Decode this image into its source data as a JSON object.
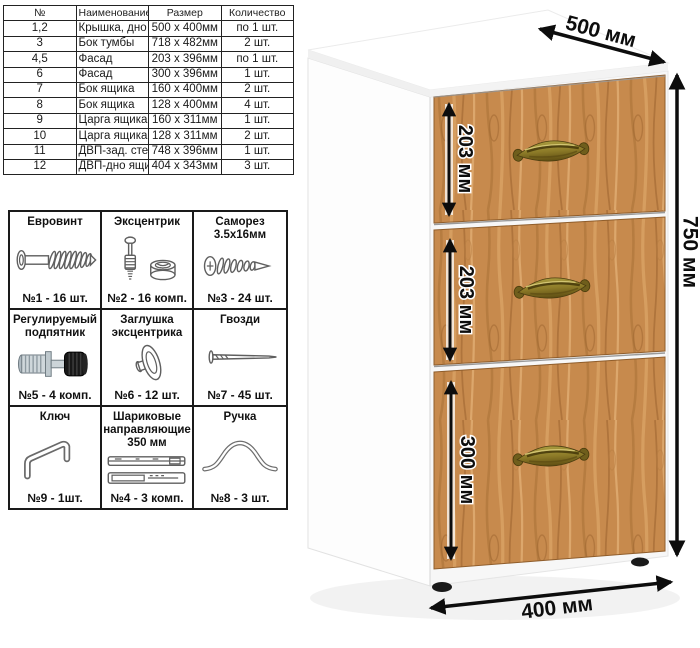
{
  "parts_table": {
    "headers": {
      "num": "№",
      "name": "Наименование детали",
      "size": "Размер",
      "qty": "Количество"
    },
    "rows": [
      {
        "num": "1,2",
        "name": "Крышка, дно тумбы",
        "size": "500 x 400мм",
        "qty": "по 1 шт."
      },
      {
        "num": "3",
        "name": "Бок тумбы",
        "size": "718 x 482мм",
        "qty": "2 шт."
      },
      {
        "num": "4,5",
        "name": "Фасад",
        "size": "203 x 396мм",
        "qty": "по 1 шт."
      },
      {
        "num": "6",
        "name": "Фасад",
        "size": "300 x 396мм",
        "qty": "1 шт."
      },
      {
        "num": "7",
        "name": "Бок ящика",
        "size": "160 x 400мм",
        "qty": "2 шт."
      },
      {
        "num": "8",
        "name": "Бок ящика",
        "size": "128 x 400мм",
        "qty": "4 шт."
      },
      {
        "num": "9",
        "name": "Царга ящика",
        "size": "160 x 311мм",
        "qty": "1 шт."
      },
      {
        "num": "10",
        "name": "Царга ящика",
        "size": "128 x 311мм",
        "qty": "2 шт."
      },
      {
        "num": "11",
        "name": "ДВП-зад. стенка тумбы",
        "size": "748 x 396мм",
        "qty": "1 шт."
      },
      {
        "num": "12",
        "name": "ДВП-дно ящика",
        "size": "404 x 343мм",
        "qty": "3 шт."
      }
    ]
  },
  "hardware_table": {
    "cells": [
      {
        "title": "Евровинт",
        "count": "№1 - 16 шт."
      },
      {
        "title": "Эксцентрик",
        "count": "№2 - 16 комп."
      },
      {
        "title": "Саморез 3.5х16мм",
        "count": "№3 - 24 шт."
      },
      {
        "title": "Регулируемый подпятник",
        "count": "№5 - 4 комп."
      },
      {
        "title": "Заглушка эксцентрика",
        "count": "№6 - 12 шт."
      },
      {
        "title": "Гвозди",
        "count": "№7 - 45 шт."
      },
      {
        "title": "Ключ",
        "count": "№9 - 1шт."
      },
      {
        "title": "Шариковые направляющие 350 мм",
        "count": "№4 - 3 комп."
      },
      {
        "title": "Ручка",
        "count": "№8 - 3 шт."
      }
    ]
  },
  "cabinet": {
    "dims": {
      "top_depth": "500 мм",
      "height": "750 мм",
      "bottom_width": "400 мм",
      "drawer1": "203 мм",
      "drawer2": "203 мм",
      "drawer3": "300 мм"
    },
    "colors": {
      "wood_base": "#c78a4d",
      "wood_dark": "#9e6630",
      "wood_light": "#e2b077",
      "handle_brass": "#8d7b28",
      "dimension": "#0d0d0d",
      "body_white": "#ffffff"
    }
  }
}
